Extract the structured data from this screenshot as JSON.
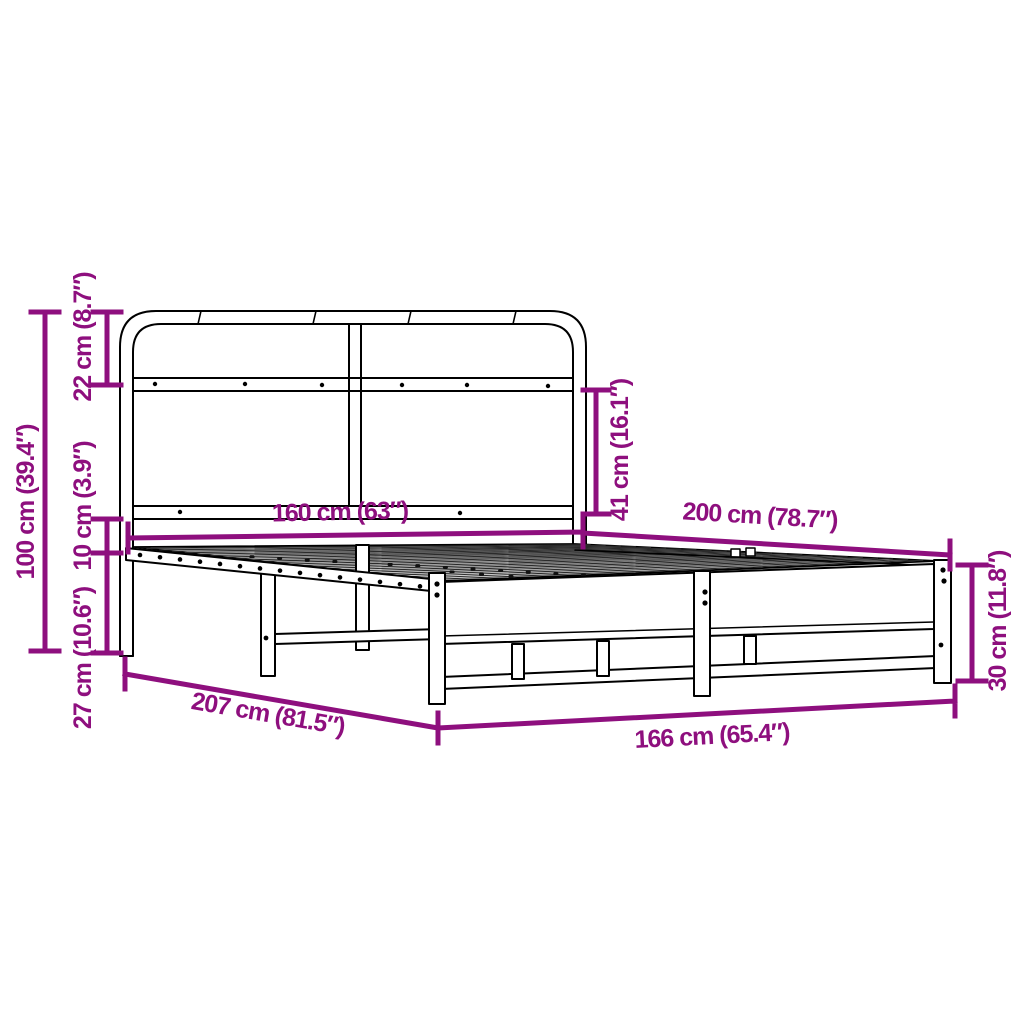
{
  "page": {
    "title": "Metal bed frame with headboard – dimension diagram",
    "background": "#FFFFFF"
  },
  "colors": {
    "dimension_accent": "#8E0F7E",
    "line_art": "#000000"
  },
  "diagram": {
    "type": "product-dimension-diagram",
    "subject": "metal bed frame with headboard and slatted base",
    "dimensions": {
      "headboard_height": {
        "label": "100 cm (39.4″)",
        "cm": 100,
        "in": 39.4
      },
      "headboard_top": {
        "label": "22 cm (8.7″)",
        "cm": 22,
        "in": 8.7
      },
      "rail_gap": {
        "label": "10 cm (3.9″)",
        "cm": 10,
        "in": 3.9
      },
      "underbed_clearance": {
        "label": "27 cm (10.6″)",
        "cm": 27,
        "in": 10.6
      },
      "mattress_width": {
        "label": "160 cm (63″)",
        "cm": 160,
        "in": 63
      },
      "mattress_length": {
        "label": "200 cm (78.7″)",
        "cm": 200,
        "in": 78.7
      },
      "headboard_above_base": {
        "label": "41 cm (16.1″)",
        "cm": 41,
        "in": 16.1
      },
      "base_height": {
        "label": "30 cm (11.8″)",
        "cm": 30,
        "in": 11.8
      },
      "total_length": {
        "label": "207 cm (81.5″)",
        "cm": 207,
        "in": 81.5
      },
      "total_width": {
        "label": "166 cm (65.4″)",
        "cm": 166,
        "in": 65.4
      }
    }
  }
}
